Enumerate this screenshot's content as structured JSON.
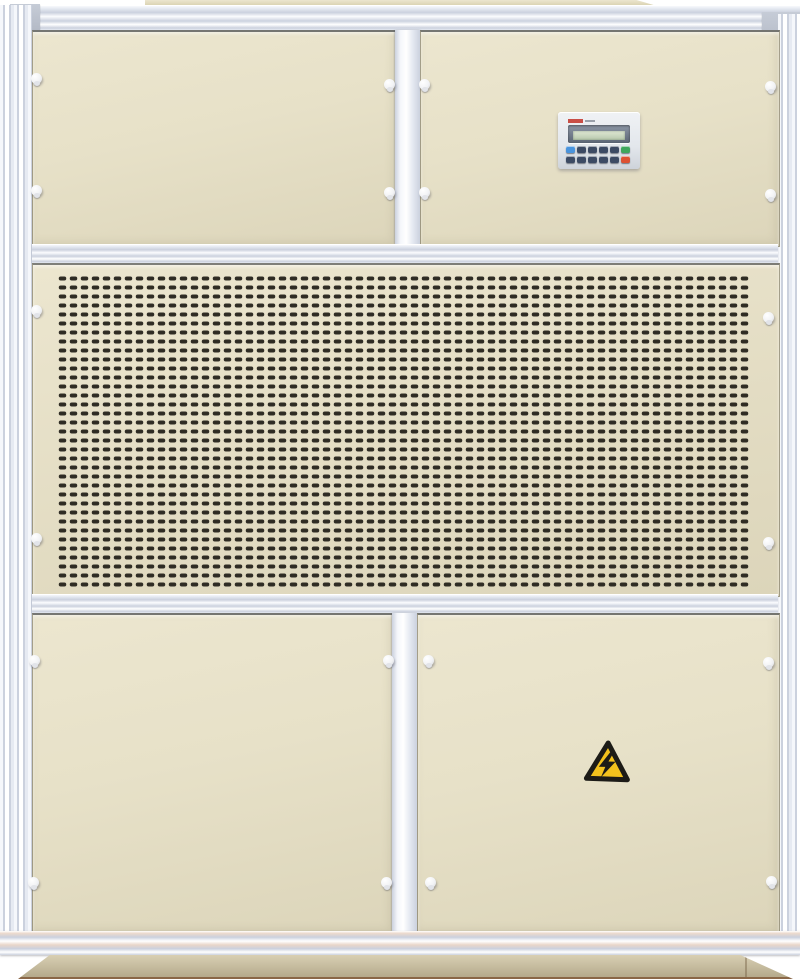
{
  "scene": {
    "type": "photograph",
    "subject": "Industrial air-handling / dehumidifier cabinet unit, front view",
    "visible_text": "none legible (tiny red brand mark on controller faceplate)"
  },
  "colors": {
    "bg": "#ffffff",
    "beige": "#e7e1c8",
    "beige-light": "#ece6cf",
    "beige-dark": "#dcd5ba",
    "roof": "#d8d0ae",
    "frame-a": "#f5f7fb",
    "frame-b": "#cbd1de",
    "frame-c": "#e6eaf2",
    "corner": "#b4bac6",
    "slot": "#2f2c24",
    "plinth-a": "#d8cfb3",
    "plinth-b": "#b5aa8c",
    "plinth-edge": "#8a6747",
    "cp-face": "#e3e7ec",
    "cp-bezel-a": "#8d97a6",
    "cp-bezel-b": "#5c6675",
    "lcd-a": "#dfe8d4",
    "lcd-b": "#b7c8ac",
    "logo-red": "#c23128",
    "btn-navy": "#3c4a63",
    "btn-blue": "#4a94dd",
    "btn-green": "#3fa65c",
    "btn-red": "#dd5132",
    "warn-yellow": "#f2c11d",
    "warn-border": "#1c1b17"
  },
  "control_panel": {
    "display": "blank teal LCD, no legible characters",
    "keypad_rows": [
      [
        "btn-blue",
        "btn-navy",
        "btn-navy",
        "btn-navy",
        "btn-navy",
        "btn-green"
      ],
      [
        "btn-navy",
        "btn-navy",
        "btn-navy",
        "btn-navy",
        "btn-navy",
        "btn-red"
      ]
    ]
  },
  "grille": {
    "tile_w": 11,
    "tile_h": 9,
    "slot_w": 7.5,
    "slot_h": 4,
    "slot_rx": 2,
    "width": 692,
    "height": 313
  },
  "latches": [
    [
      36,
      78
    ],
    [
      36,
      190
    ],
    [
      389,
      84
    ],
    [
      389,
      192
    ],
    [
      424,
      84
    ],
    [
      424,
      192
    ],
    [
      770,
      86
    ],
    [
      770,
      194
    ],
    [
      36,
      310
    ],
    [
      36,
      538
    ],
    [
      768,
      317
    ],
    [
      768,
      542
    ],
    [
      34,
      660
    ],
    [
      33,
      882
    ],
    [
      388,
      660
    ],
    [
      386,
      882
    ],
    [
      428,
      660
    ],
    [
      430,
      882
    ],
    [
      768,
      662
    ],
    [
      771,
      881
    ]
  ],
  "warning_sign": {
    "meaning": "electrical-hazard",
    "symbol": "lightning-bolt"
  }
}
